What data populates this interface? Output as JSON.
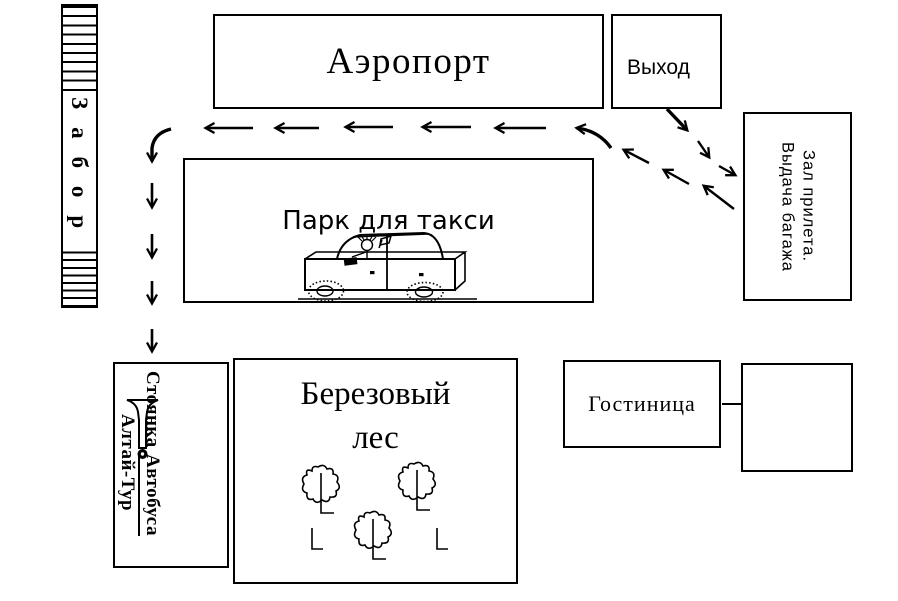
{
  "labels": {
    "airport": "Аэропорт",
    "exit": "Выход",
    "arrival_hall": [
      "Зал прилета.",
      "Выдача багажа"
    ],
    "taxi_park": "Парк для такси",
    "fence": "Забор",
    "bus_stop": {
      "word1": "Стоянка",
      "word2": "Автобуса",
      "line2": "Алтай-Тур"
    },
    "forest": [
      "Березовый",
      "лес"
    ],
    "hotel": "Гостиница"
  },
  "icons": {
    "car": "car-icon",
    "tree": "tree-icon",
    "horn": "horn-icon",
    "corner_mark": "corner-mark-icon",
    "route_arrow": "dashed-arrow"
  },
  "colors": {
    "ink": "#000000",
    "background": "#ffffff"
  }
}
